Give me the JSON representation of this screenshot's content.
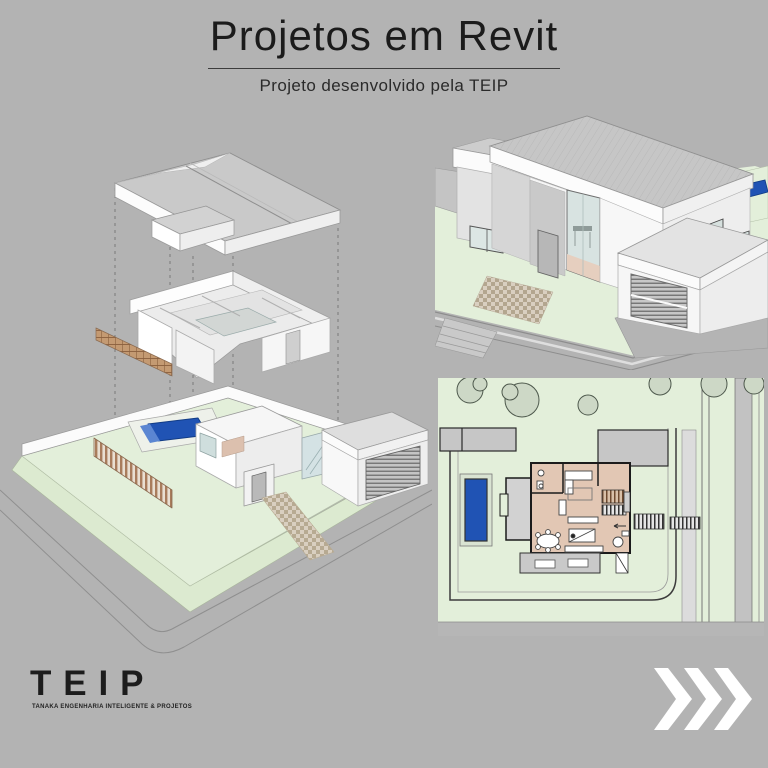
{
  "header": {
    "title": "Projetos em Revit",
    "subtitle": "Projeto desenvolvido pela TEIP"
  },
  "branding": {
    "logo": "TEIP",
    "tagline": "TANAKA ENGENHARIA INTELIGENTE & PROJETOS"
  },
  "navigation": {
    "next_icon": "triple-chevron-right"
  },
  "colors": {
    "background": "#b3b3b3",
    "heading_text": "#1b1b1b",
    "lawn_green": "#e3efda",
    "pool_blue": "#2053b4",
    "floor_tan": "#e2c7b4",
    "roof_gray": "#c6c6c6",
    "wall_white": "#f8f8f8",
    "wood_brown": "#a97c5c",
    "arrow_white": "#ffffff"
  }
}
